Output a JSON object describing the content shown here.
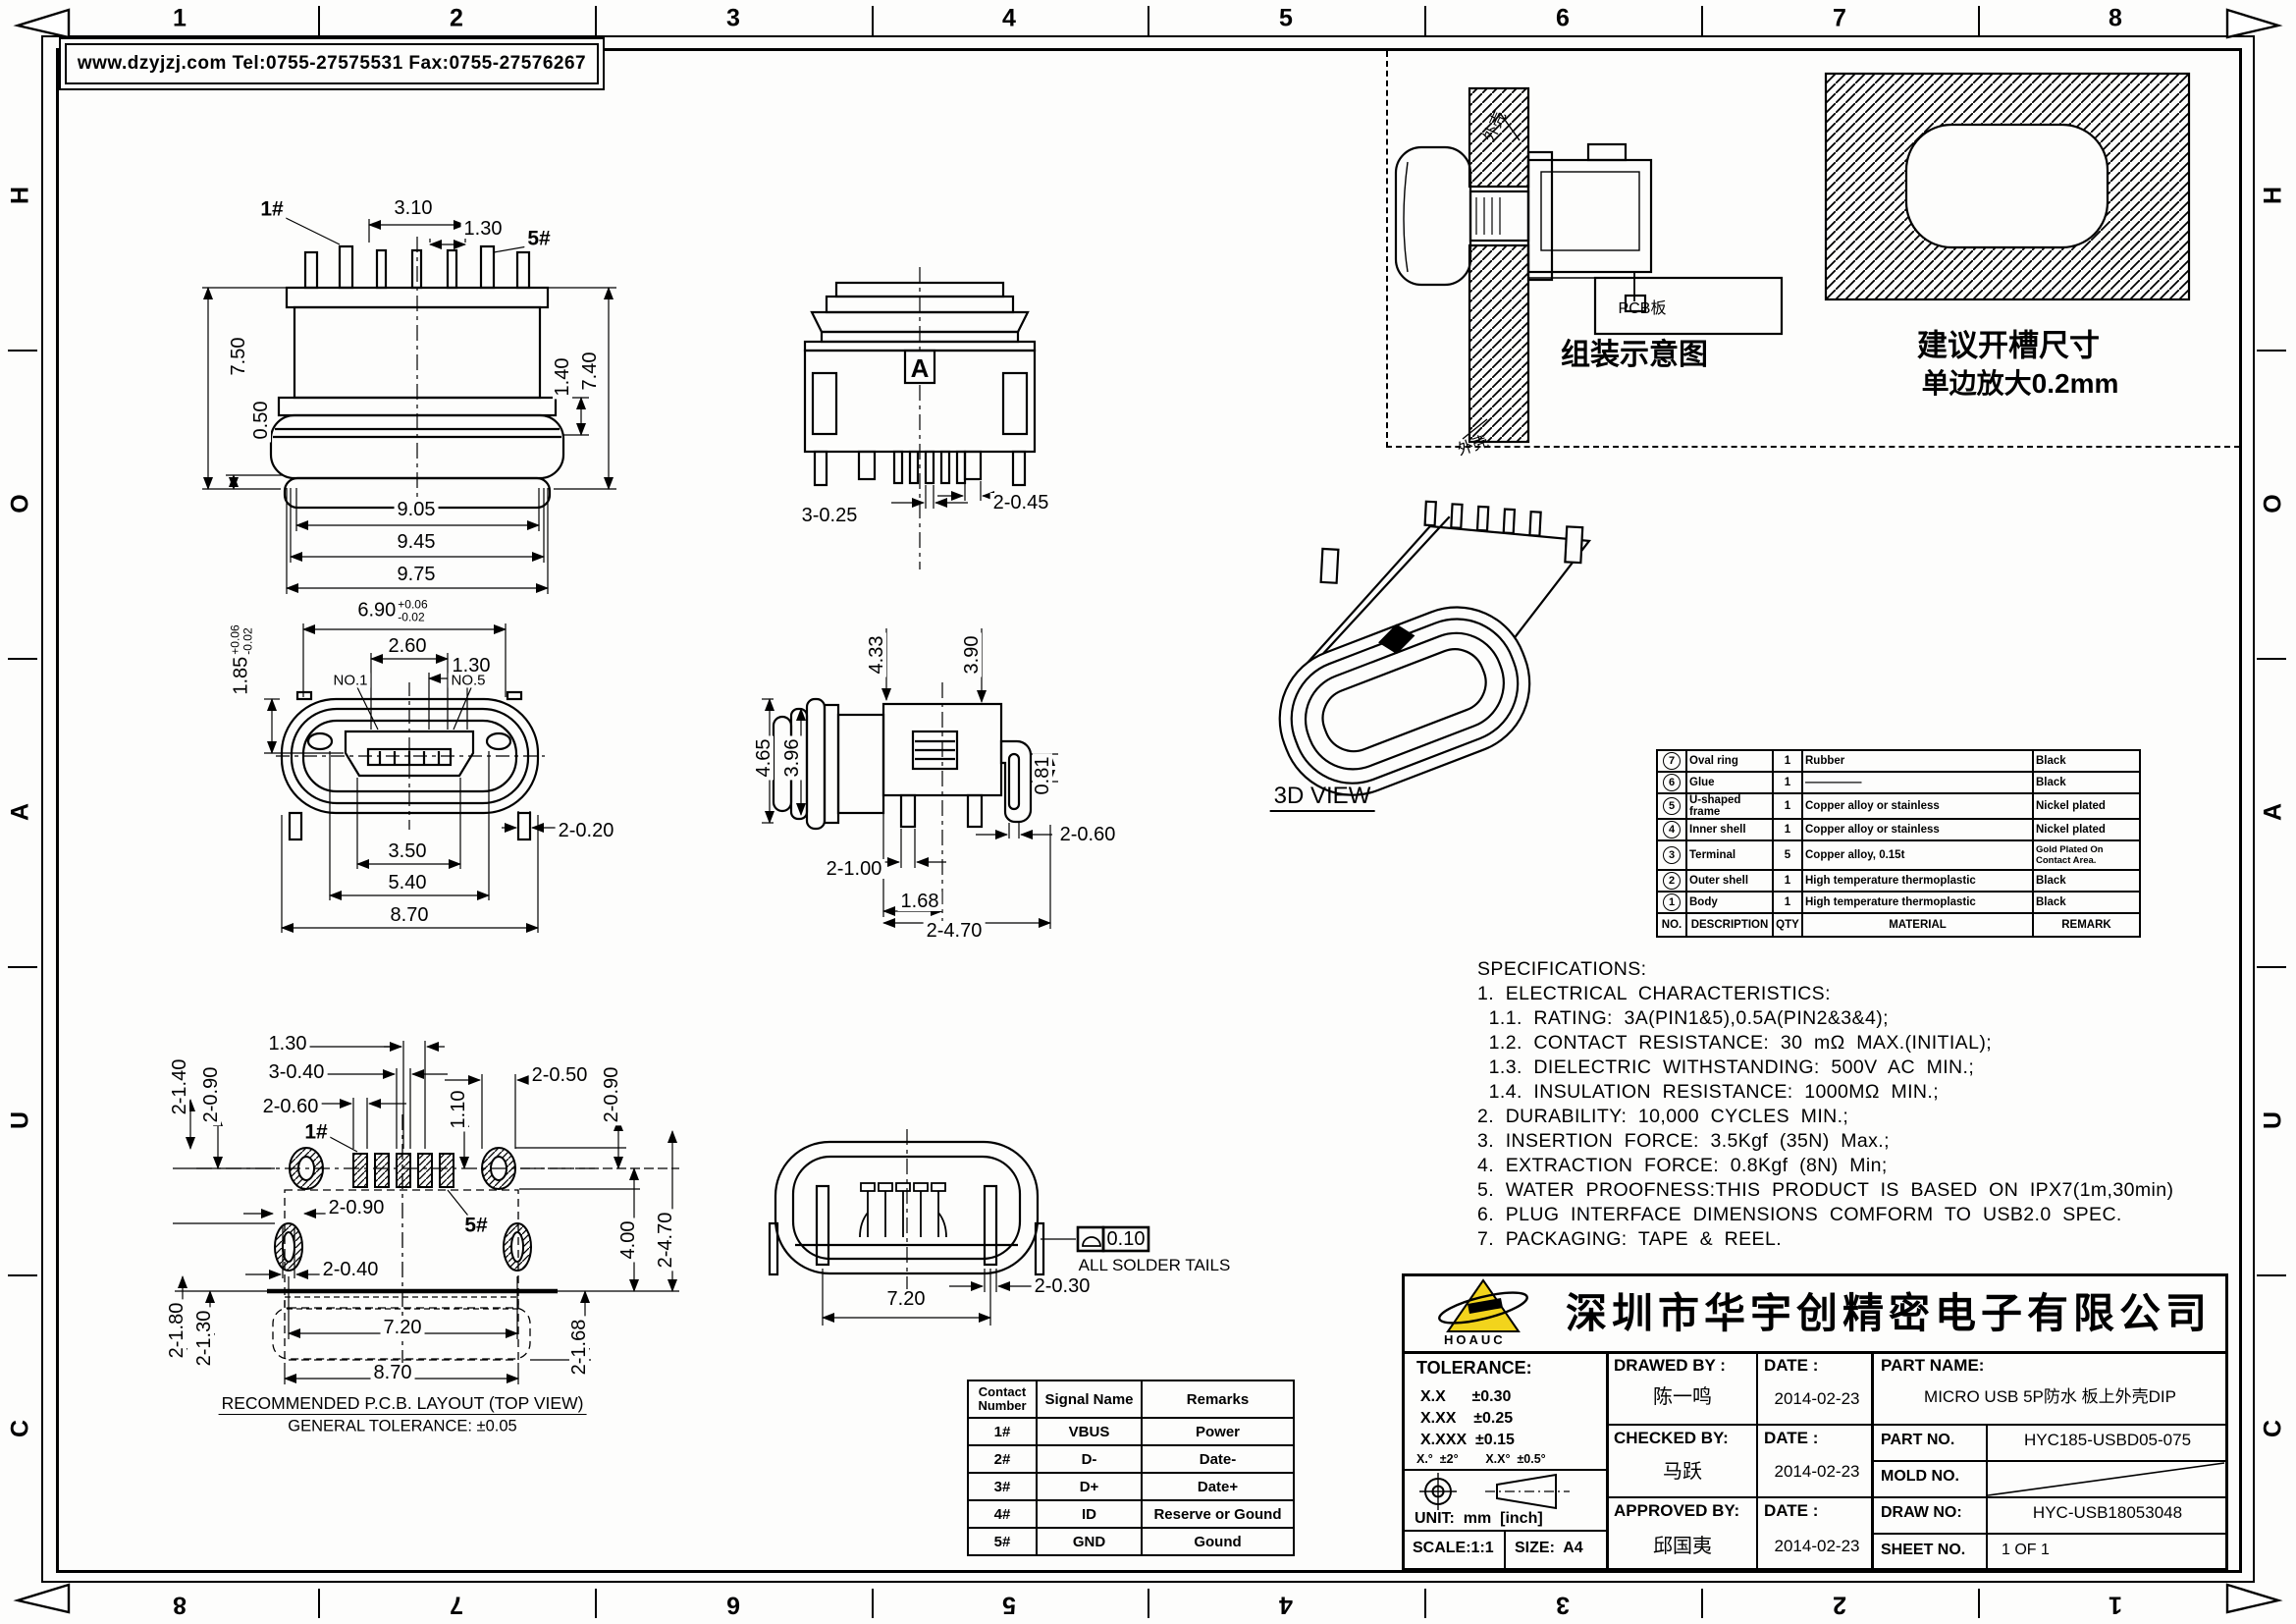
{
  "frame": {
    "header": "www.dzyjzj.com  Tel:0755-27575531  Fax:0755-27576267",
    "zones_top": [
      "1",
      "2",
      "3",
      "4",
      "5",
      "6",
      "7",
      "8"
    ],
    "zones_bottom": [
      "8",
      "7",
      "6",
      "5",
      "4",
      "3",
      "2",
      "1"
    ],
    "zones_left": [
      "H",
      "O",
      "A",
      "U",
      "C"
    ],
    "zones_right": [
      "H",
      "O",
      "A",
      "U",
      "C"
    ]
  },
  "assembly": {
    "caption": "组装示意图",
    "pcb_label": "PCB板",
    "shell_top": "外壳",
    "shell_bottom": "外壳",
    "slot_title": "建议开槽尺寸",
    "slot_subtitle": "单边放大0.2mm"
  },
  "views": {
    "three_d_label": "3D VIEW",
    "section_label": "A",
    "pcb_caption": "RECOMMENDED P.C.B. LAYOUT (TOP VIEW)",
    "pcb_tolerance": "GENERAL TOLERANCE: ±0.05",
    "solder_note": "ALL SOLDER TAILS",
    "flatness": "0.10"
  },
  "dims": {
    "rear": {
      "w1": "3.10",
      "pitch": "1.30",
      "pin1": "1#",
      "pin5": "5#",
      "h1": "7.50",
      "h2": "0.50",
      "h3": "1.40",
      "h4": "7.40",
      "b1": "9.05",
      "b2": "9.45",
      "b3": "9.75"
    },
    "front": {
      "w": "6.90",
      "w_tol_p": "+0.06",
      "w_tol_m": "-0.02",
      "w2": "2.60",
      "pitch": "1.30",
      "no1": "NO.1",
      "no5": "NO.5",
      "h": "1.85",
      "h_tol_p": "+0.06",
      "h_tol_m": "-0.02",
      "peg": "2-0.20",
      "b1": "3.50",
      "b2": "5.40",
      "b3": "8.70"
    },
    "top": {
      "pin": "3-0.25",
      "pad": "2-0.45"
    },
    "side": {
      "t1": "4.33",
      "t2": "3.90",
      "l1": "4.65",
      "l2": "3.96",
      "r1": "0.81",
      "r2": "2-0.60",
      "b1": "2-1.00",
      "b2": "1.68",
      "b3": "2-4.70"
    },
    "pcb": {
      "p1": "1.30",
      "p2": "3-0.40",
      "p3": "2-0.60",
      "p4": "2-1.40",
      "p5": "2-0.90",
      "p6": "1.10",
      "p7": "2-0.50",
      "p8": "2-0.90",
      "p9": "2-0.90",
      "p10": "2-0.40",
      "p11": "4.00",
      "p12": "2-4.70",
      "p13": "2-1.80",
      "p14": "2-1.30",
      "p15": "7.20",
      "p16": "8.70",
      "p17": "2-1.68",
      "pin1": "1#",
      "pin5": "5#"
    },
    "bottom": {
      "b1": "7.20",
      "b2": "2-0.30"
    }
  },
  "parts_table": {
    "headers": {
      "no": "NO.",
      "desc": "DESCRIPTION",
      "qty": "QTY",
      "material": "MATERIAL",
      "remark": "REMARK"
    },
    "rows": [
      {
        "no": "7",
        "desc": "Oval ring",
        "qty": "1",
        "material": "Rubber",
        "remark": "Black"
      },
      {
        "no": "6",
        "desc": "Glue",
        "qty": "1",
        "material": "—————",
        "remark": "Black"
      },
      {
        "no": "5",
        "desc": "U-shaped frame",
        "qty": "1",
        "material": "Copper alloy or stainless",
        "remark": "Nickel plated"
      },
      {
        "no": "4",
        "desc": "Inner shell",
        "qty": "1",
        "material": "Copper alloy or stainless",
        "remark": "Nickel plated"
      },
      {
        "no": "3",
        "desc": "Terminal",
        "qty": "5",
        "material": "Copper alloy, 0.15t",
        "remark": "Gold Plated On Contact Area."
      },
      {
        "no": "2",
        "desc": "Outer shell",
        "qty": "1",
        "material": "High temperature thermoplastic",
        "remark": "Black"
      },
      {
        "no": "1",
        "desc": "Body",
        "qty": "1",
        "material": "High temperature thermoplastic",
        "remark": "Black"
      }
    ]
  },
  "specs": {
    "lines": [
      "SPECIFICATIONS:",
      "1.  ELECTRICAL  CHARACTERISTICS:",
      "  1.1.  RATING:  3A(PIN1&5),0.5A(PIN2&3&4);",
      "  1.2.  CONTACT  RESISTANCE:  30  mΩ  MAX.(INITIAL);",
      "  1.3.  DIELECTRIC  WITHSTANDING:  500V  AC  MIN.;",
      "  1.4.  INSULATION  RESISTANCE:  1000MΩ  MIN.;",
      "2.  DURABILITY:  10,000  CYCLES  MIN.;",
      "3.  INSERTION  FORCE:  3.5Kgf  (35N)  Max.;",
      "4.  EXTRACTION  FORCE:  0.8Kgf  (8N)  Min;",
      "5.  WATER  PROOFNESS:THIS  PRODUCT  IS  BASED  ON  IPX7(1m,30min)",
      "6.  PLUG  INTERFACE  DIMENSIONS  COMFORM  TO  USB2.0  SPEC.",
      "7.  PACKAGING:  TAPE  &  REEL."
    ]
  },
  "contact_table": {
    "h1": "Contact Number",
    "h2": "Signal Name",
    "h3": "Remarks",
    "rows": [
      {
        "n": "1#",
        "signal": "VBUS",
        "remark": "Power"
      },
      {
        "n": "2#",
        "signal": "D-",
        "remark": "Date-"
      },
      {
        "n": "3#",
        "signal": "D+",
        "remark": "Date+"
      },
      {
        "n": "4#",
        "signal": "ID",
        "remark": "Reserve or Gound"
      },
      {
        "n": "5#",
        "signal": "GND",
        "remark": "Gound"
      }
    ]
  },
  "title_block": {
    "logo_text": "HOAUC",
    "company": "深圳市华宇创精密电子有限公司",
    "tolerance_title": "TOLERANCE:",
    "tol1": "X.X      ±0.30",
    "tol2": "X.XX    ±0.25",
    "tol3": "X.XXX  ±0.15",
    "tol_angles": "X.°  ±2°        X.X°  ±0.5°",
    "unit": "UNIT:  mm  [inch]",
    "scale": "SCALE:1:1",
    "size": "SIZE:  A4",
    "drawed_label": "DRAWED BY :",
    "drawed_name": "陈一鸣",
    "drawed_date": "2014-02-23",
    "checked_label": "CHECKED BY:",
    "checked_name": "马跃",
    "checked_date": "2014-02-23",
    "approved_label": "APPROVED BY:",
    "approved_name": "邱国夷",
    "approved_date": "2014-02-23",
    "date_label": "DATE :",
    "part_name_label": "PART NAME:",
    "part_name": "MICRO USB 5P防水 板上外壳DIP",
    "part_no_label": "PART NO.",
    "part_no": "HYC185-USBD05-075",
    "mold_no_label": "MOLD NO.",
    "draw_no_label": "DRAW NO:",
    "draw_no": "HYC-USB18053048",
    "sheet_no_label": "SHEET NO.",
    "sheet_no": "1 OF 1"
  }
}
